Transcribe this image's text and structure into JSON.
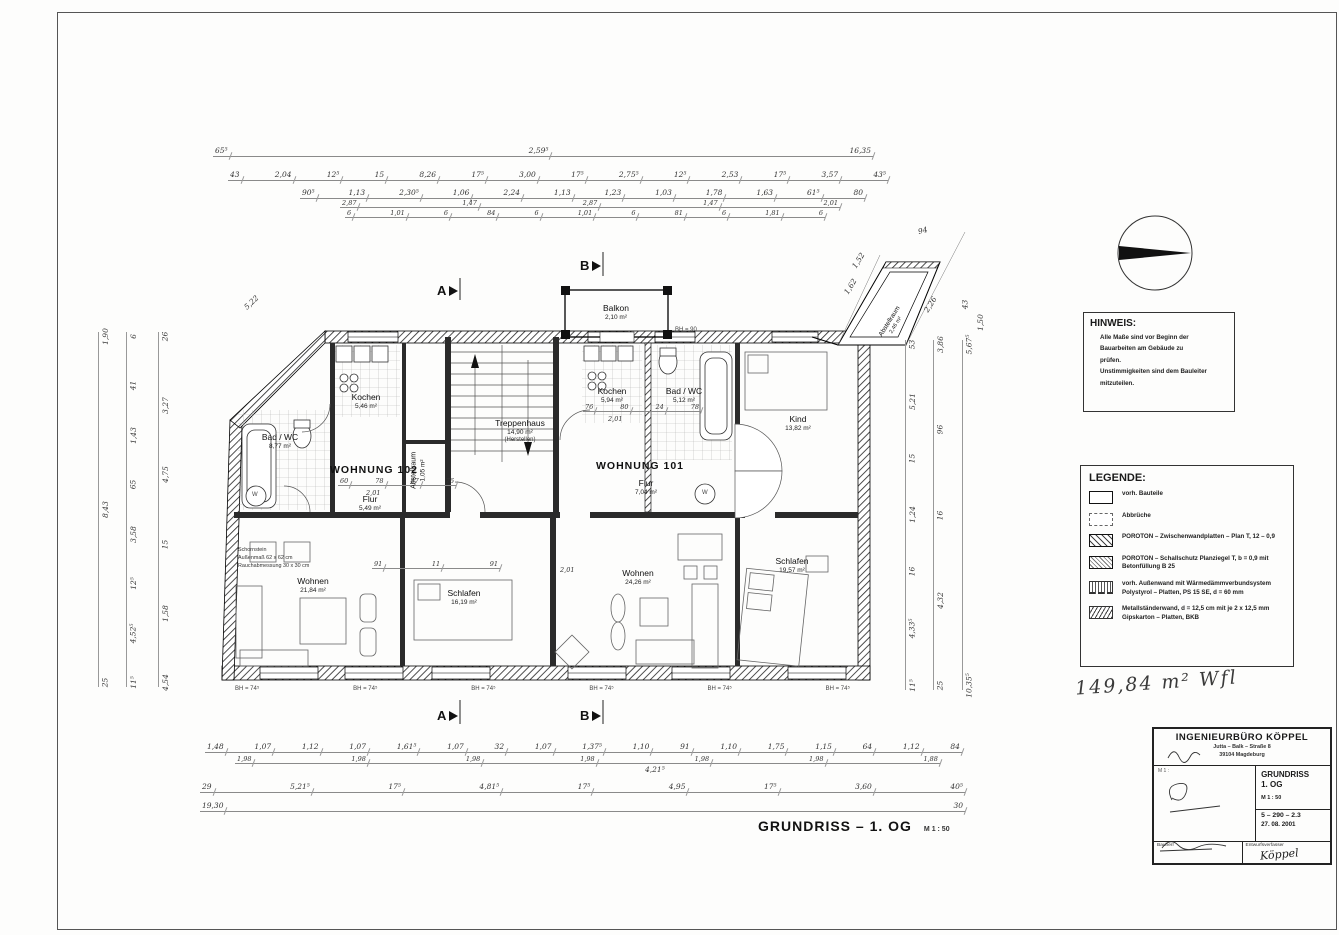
{
  "sheet": {
    "plan_title": "GRUNDRISS – 1. OG",
    "plan_scale": "M 1 : 50",
    "handwritten_note": "149,84 m² Wfl"
  },
  "sections": {
    "a": "A",
    "b": "B"
  },
  "apartments": {
    "w102_name": "WOHNUNG 102",
    "w101_name": "WOHNUNG 101"
  },
  "rooms": {
    "bad102": {
      "label": "Bad / WC",
      "area": "8,77 m²"
    },
    "kochen102": {
      "label": "Kochen",
      "area": "5,46 m²"
    },
    "abstell102": {
      "label": "Abstellraum",
      "area": "1,05 m²"
    },
    "flur102": {
      "label": "Flur",
      "area": "5,49 m²"
    },
    "wohnen102": {
      "label": "Wohnen",
      "area": "21,84 m²"
    },
    "schlafen102": {
      "label": "Schlafen",
      "area": "16,19 m²"
    },
    "treppenhaus": {
      "label": "Treppenhaus",
      "area": "14,90 m²",
      "note": "(Herstellen)"
    },
    "balkon": {
      "label": "Balkon",
      "area": "2,10 m²"
    },
    "kochen101": {
      "label": "Kochen",
      "area": "5,94 m²"
    },
    "bad101": {
      "label": "Bad / WC",
      "area": "5,12 m²"
    },
    "kind": {
      "label": "Kind",
      "area": "13,82 m²"
    },
    "flur101": {
      "label": "Flur",
      "area": "7,04 m²"
    },
    "wohnen101": {
      "label": "Wohnen",
      "area": "24,26 m²"
    },
    "schlafen101": {
      "label": "Schlafen",
      "area": "19,57 m²"
    },
    "abstell_annex": {
      "label": "Abstellraum",
      "area": "2,46 m²"
    }
  },
  "chimney": {
    "lines": [
      "Schornstein",
      "Außenmaß 62 x 62 cm",
      "Rauchabmessung 30 x 30 cm"
    ]
  },
  "plan": {
    "washer_label": "W",
    "bh_balkon": "BH = 90",
    "d201": "2,01",
    "d4215": "4,21⁵"
  },
  "dimensions": {
    "top": {
      "r1": [
        "65⁵",
        "2,59⁵",
        "16,35"
      ],
      "r2": [
        "43",
        "2,04",
        "12⁵",
        "15",
        "8,26",
        "17⁵",
        "3,00",
        "17⁵",
        "2,75⁵",
        "12⁵",
        "2,53",
        "17⁵",
        "3,57",
        "43⁵"
      ],
      "r3": [
        "90⁵",
        "1,13",
        "2,30⁵",
        "1,06",
        "2,24",
        "1,13",
        "1,23",
        "1,03",
        "1,78",
        "1,63",
        "61⁵",
        "80"
      ],
      "r4": [
        "2,87",
        "1,47",
        "2,87",
        "1,47",
        "2,01"
      ],
      "r5": [
        "6",
        "1,01",
        "6",
        "84",
        "6",
        "1,01",
        "6",
        "81",
        "6",
        "1,81",
        "6"
      ]
    },
    "bottom": {
      "r1": [
        "1,48",
        "1,07",
        "1,12",
        "1,07",
        "1,61⁵",
        "1,07",
        "32",
        "1,07",
        "1,37⁵",
        "1,10",
        "91",
        "1,10",
        "1,75",
        "1,15",
        "64",
        "1,12",
        "84"
      ],
      "r2": [
        "1,98",
        "1,98",
        "1,98",
        "1,98",
        "1,98",
        "1,98",
        "1,88"
      ],
      "r3": [
        "29",
        "5,21⁵",
        "17⁵",
        "4,81⁵",
        "17⁵",
        "4,95",
        "17⁵",
        "3,60",
        "40⁵"
      ],
      "r4": [
        "19,30",
        "30"
      ]
    },
    "left": {
      "colA": [
        "1,90",
        "8,43",
        "25"
      ],
      "colB": [
        "6",
        "41",
        "1,43",
        "65",
        "3,58",
        "12⁵",
        "4,52⁵",
        "11⁵"
      ],
      "colC": [
        "26",
        "3,27",
        "4,75",
        "15",
        "1,58",
        "4,54"
      ]
    },
    "right": {
      "colD": [
        "53",
        "5,21",
        "15",
        "1,24",
        "16",
        "4,33⁵",
        "11⁵"
      ],
      "colE": [
        "3,86",
        "96",
        "16",
        "4,32",
        "25"
      ],
      "colF": [
        "5,67⁵",
        "10,35⁵"
      ]
    },
    "interior": {
      "flur102": [
        "60",
        "78",
        "87",
        "76"
      ],
      "flur101": [
        "76",
        "80",
        "24",
        "78"
      ],
      "mid": [
        "91",
        "11",
        "91"
      ]
    },
    "annex": {
      "d94": "94",
      "d162": "1,62",
      "d152": "1,52",
      "d226": "2,26",
      "d150": "1,50",
      "d43": "43",
      "d522": "5,22"
    },
    "bh": [
      "BH = 74⁵",
      "BH = 74⁵",
      "BH = 74⁵",
      "BH = 74⁵",
      "BH = 74⁵",
      "BH = 74⁵"
    ]
  },
  "hinweis": {
    "title": "HINWEIS:",
    "lines": [
      "Alle Maße sind vor Beginn der",
      "Bauarbeiten am Gebäude zu",
      "prüfen.",
      "Unstimmigkeiten sind dem Bauleiter",
      "mitzuteilen."
    ]
  },
  "legende": {
    "title": "LEGENDE:",
    "items": [
      {
        "symbol": "solid-rect",
        "label": "vorh. Bauteile"
      },
      {
        "symbol": "dashed-rect",
        "label": "Abbrüche"
      },
      {
        "symbol": "diagonal-hatch",
        "label": "POROTON – Zwischenwandplatten – Plan T, 12 – 0,9"
      },
      {
        "symbol": "dense-hatch",
        "label": "POROTON – Schallschutz Planziegel T, b = 0,9 mit Betonfüllung B 25"
      },
      {
        "symbol": "insulation",
        "label": "vorh. Außenwand mit Wärmedämmverbundsystem Polystyrol – Platten, PS 15 SE, d = 60 mm"
      },
      {
        "symbol": "zigzag",
        "label": "Metallständerwand, d = 12,5 cm mit je 2 x 12,5 mm Gipskarton – Platten, BKB"
      }
    ]
  },
  "titleblock": {
    "firm": "INGENIEURBÜRO  KÖPPEL",
    "address1": "Jutta – Balk – Straße 8",
    "address2": "39104 Magdeburg",
    "drawing_title_line1": "GRUNDRISS",
    "drawing_title_line2": "1. OG",
    "scale": "M 1 : 50",
    "scale_small": "M 1 :",
    "doc_number": "5 – 290 – 2.3",
    "date": "27. 08. 2001",
    "label_bauherr": "Bauherr",
    "label_entwurfsverfasser": "Entwurfsverfasser",
    "signature": "Köppel"
  }
}
